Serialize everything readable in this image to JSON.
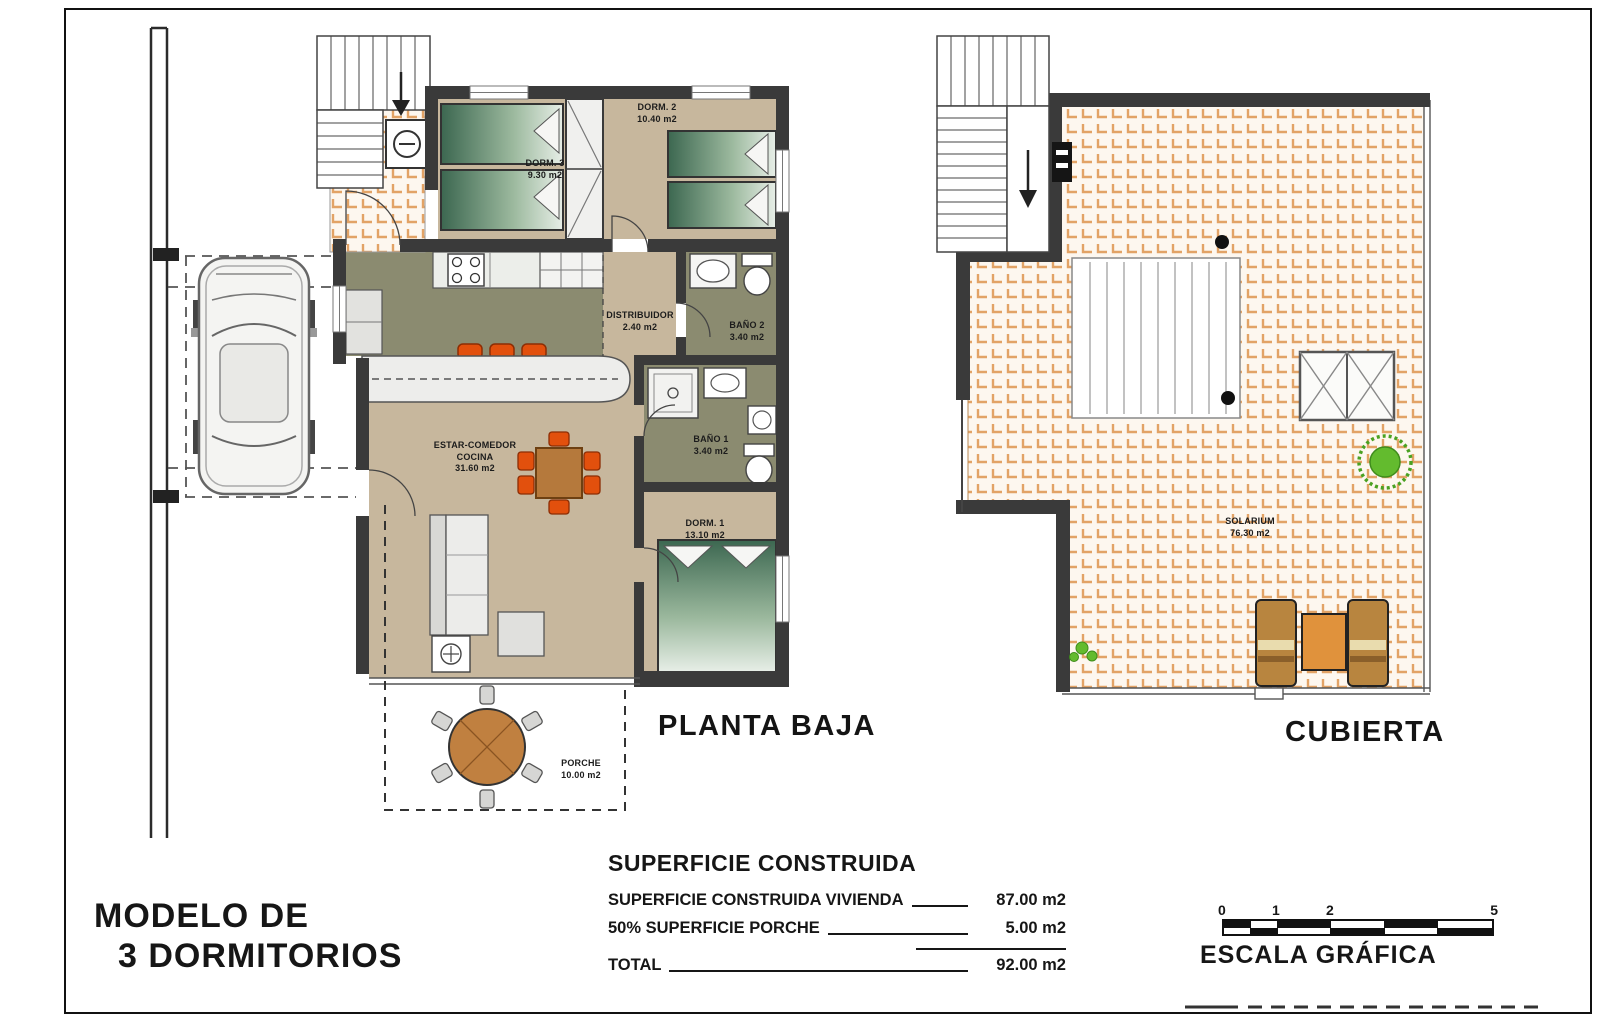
{
  "title_block": {
    "line1": "MODELO DE",
    "line2": "3 DORMITORIOS"
  },
  "plans": {
    "planta_baja": {
      "title": "PLANTA BAJA",
      "rooms": [
        {
          "name": "DORM. 3",
          "area": "9.30 m2"
        },
        {
          "name": "DORM. 2",
          "area": "10.40 m2"
        },
        {
          "name": "DISTRIBUIDOR",
          "area": "2.40 m2"
        },
        {
          "name": "BAÑO 2",
          "area": "3.40 m2"
        },
        {
          "name": "BAÑO 1",
          "area": "3.40 m2"
        },
        {
          "name": "ESTAR-COMEDOR",
          "name2": "COCINA",
          "area": "31.60 m2"
        },
        {
          "name": "DORM. 1",
          "area": "13.10 m2"
        },
        {
          "name": "PORCHE",
          "area": "10.00 m2"
        }
      ]
    },
    "cubierta": {
      "title": "CUBIERTA",
      "rooms": [
        {
          "name": "SOLARIUM",
          "area": "76.30 m2"
        }
      ]
    }
  },
  "summary": {
    "heading": "SUPERFICIE CONSTRUIDA",
    "rows": [
      {
        "label": "SUPERFICIE CONSTRUIDA VIVIENDA",
        "value": "87.00 m2"
      },
      {
        "label": "50% SUPERFICIE PORCHE",
        "value": "5.00 m2"
      },
      {
        "label": "TOTAL",
        "value": "92.00 m2"
      }
    ]
  },
  "scale_bar": {
    "label": "ESCALA GRÁFICA",
    "ticks": [
      "0",
      "1",
      "2",
      "5"
    ]
  },
  "palette": {
    "wall": "#3a3a3a",
    "floor_beige": "#c7b79d",
    "wet_room_olive": "#8b8b70",
    "tile_accent": "#e2a366",
    "accent_orange": "#e2500d",
    "bed_green": "#3c6750",
    "plant_green": "#56b02c",
    "wood": "#c08040"
  }
}
